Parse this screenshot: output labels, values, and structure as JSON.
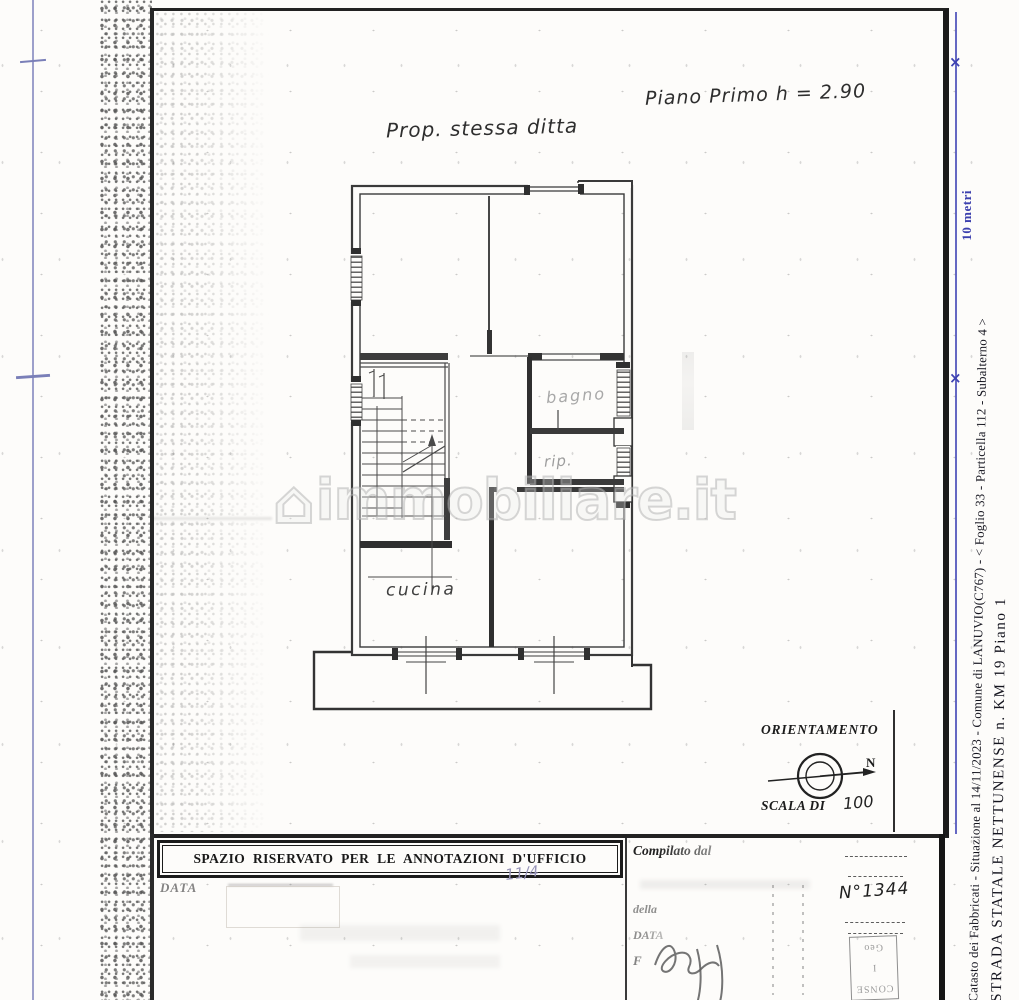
{
  "sheet": {
    "property_note": "Prop. stessa ditta",
    "floor_note": "Piano Primo h = 2.90",
    "rooms": {
      "bathroom": "bagno",
      "closet": "rip.",
      "kitchen": "cucina"
    },
    "watermark": {
      "icon": "house-icon",
      "icon_glyph": "⌂",
      "text": "immobiliare.it"
    },
    "orientation": {
      "title": "ORIENTAMENTO",
      "north": "N",
      "scale_label": "SCALA DI",
      "scale_value": "100"
    }
  },
  "margin": {
    "ruler_label": "10 metri",
    "catasto_line": "Catasto dei Fabbricati - Situazione al 14/11/2023 - Comune di LANUVIO(C767) - <  Foglio 33 - Particella  112 - Subalterno 4 >",
    "address_line": "STRADA STATALE NETTUNENSE n. KM 19 Piano 1"
  },
  "office": {
    "header": "SPAZIO RISERVATO PER LE ANNOTAZIONI D'UFFICIO",
    "data_label": "DATA",
    "hand_mark": "11/4",
    "compiled_label": "Compilato dal",
    "della_label": "della",
    "data_label_right": "DATA",
    "firma_label": "F",
    "protocol_number": "N°1344",
    "stamp_text": [
      "CONSE",
      "I",
      "Geo"
    ]
  },
  "colors": {
    "ruler_blue": "#3c40ae",
    "ink": "#1c1c1c",
    "faint_label": "#a0a0a0"
  }
}
